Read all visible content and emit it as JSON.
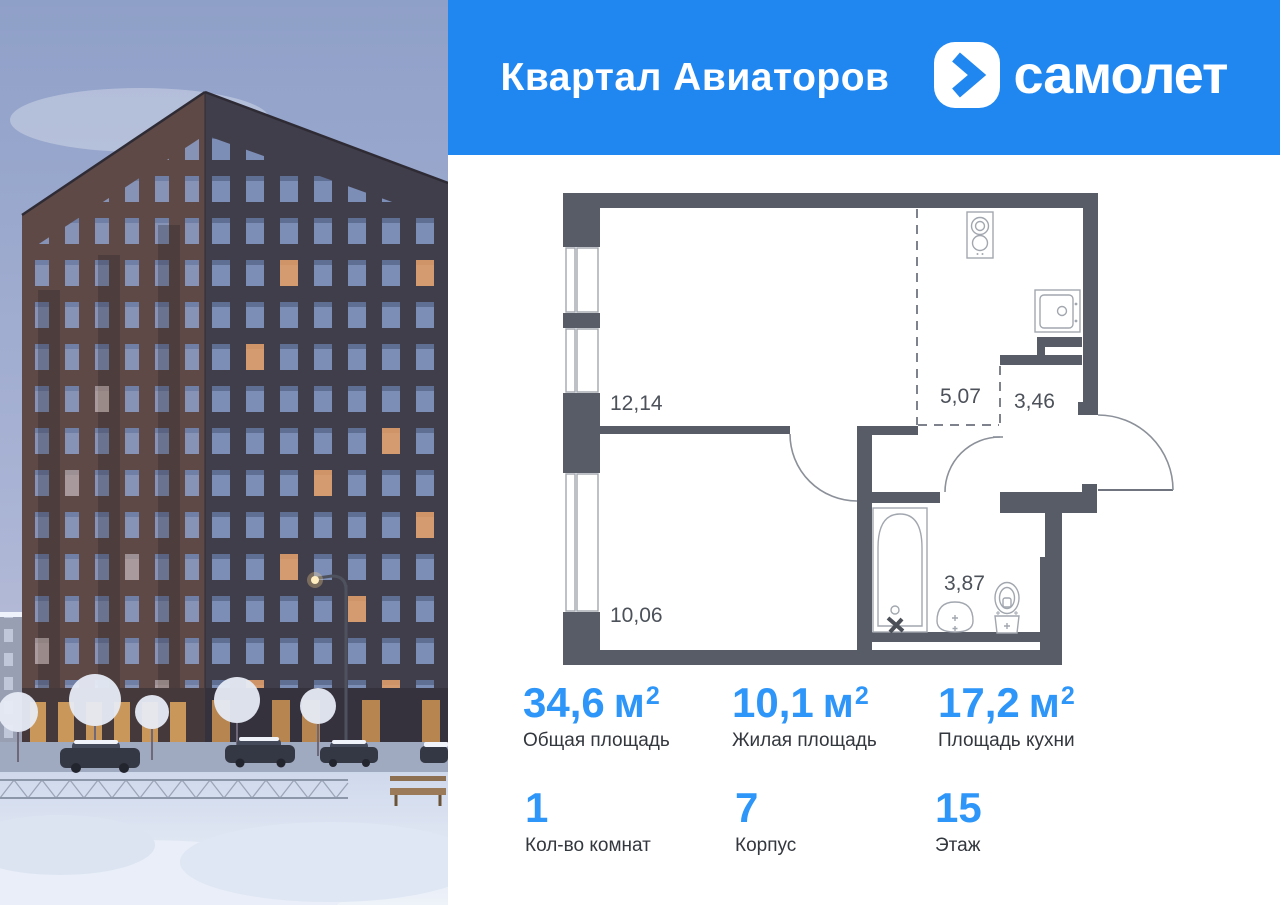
{
  "colors": {
    "brand_blue": "#2187f0",
    "value_blue": "#2e96f8",
    "wall_gray": "#575c66"
  },
  "header": {
    "project_title": "Квартал Авиаторов",
    "brand_name": "самолет",
    "logo_icon": "samolet-plane-icon"
  },
  "floorplan": {
    "room_labels": {
      "kitchen_living": "12,14",
      "kitchen_niche": "5,07",
      "hallway": "3,46",
      "bedroom": "10,06",
      "bathroom": "3,87"
    }
  },
  "stats": {
    "total_area": {
      "value": "34,6",
      "unit": "м",
      "sup": "2",
      "label": "Общая площадь"
    },
    "living_area": {
      "value": "10,1",
      "unit": "м",
      "sup": "2",
      "label": "Жилая площадь"
    },
    "kitchen_area": {
      "value": "17,2",
      "unit": "м",
      "sup": "2",
      "label": "Площадь кухни"
    },
    "room_count": {
      "value": "1",
      "label": "Кол-во комнат"
    },
    "building_number": {
      "value": "7",
      "label": "Корпус"
    },
    "floor_number": {
      "value": "15",
      "label": "Этаж"
    }
  }
}
